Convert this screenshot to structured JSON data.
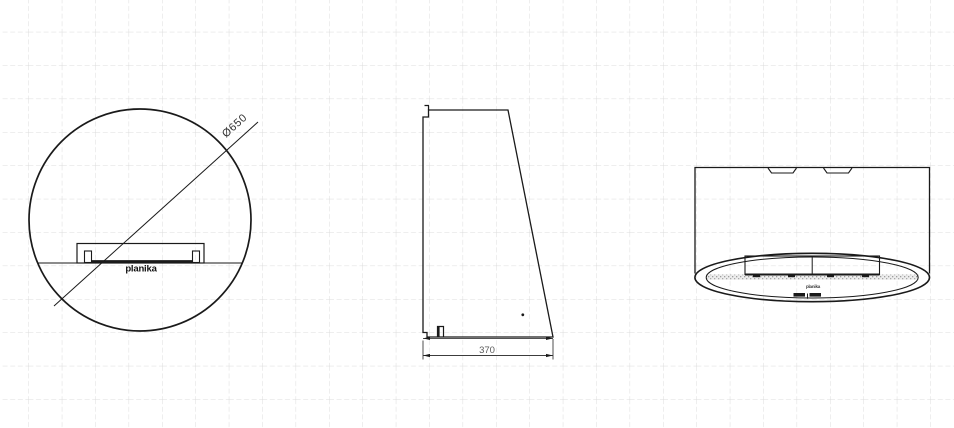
{
  "page": {
    "background": "#ffffff",
    "grid_color": "#dcdcdc",
    "line_color": "#1a1a1a",
    "dim_color": "#5a5a5a"
  },
  "front_view": {
    "diameter_dimension": "Ø650",
    "brand_label": "planika"
  },
  "side_view": {
    "width_dimension": "370"
  },
  "bottom_view": {
    "brand_label": "planika"
  }
}
